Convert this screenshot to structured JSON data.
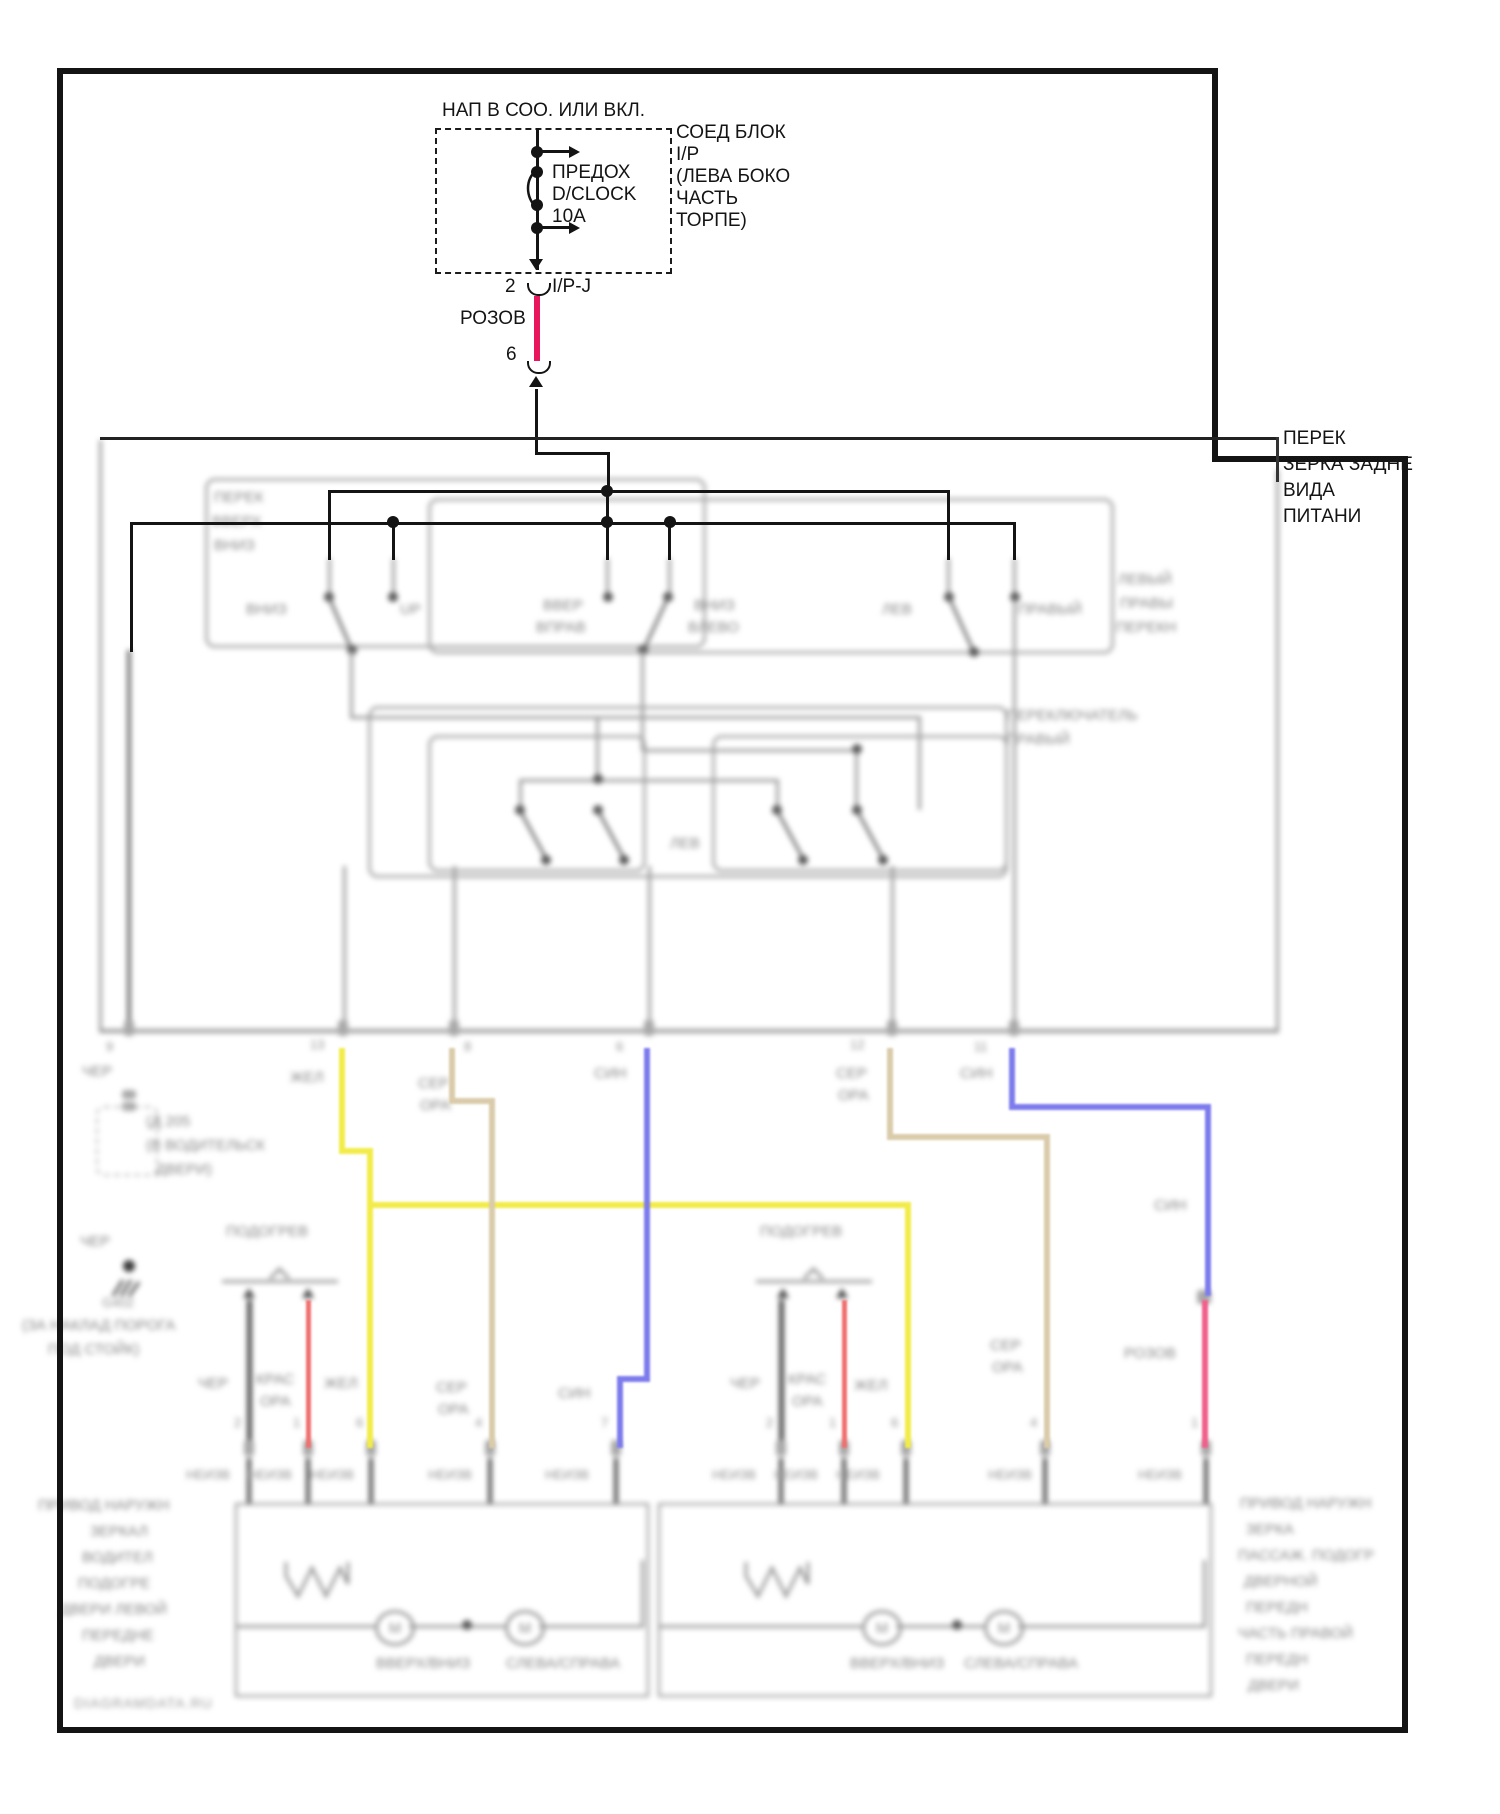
{
  "colors": {
    "wire_pink": "#e8175d",
    "wire_pink_light": "#f0608c",
    "wire_yellow": "#f2ec4a",
    "wire_tan": "#dacbaa",
    "wire_blue": "#7d7cec",
    "wire_red_orange": "#ef6f6f",
    "line_black": "#141414",
    "line_gray": "#9c9c9c",
    "text_blur": "#878787"
  },
  "fuse_block": {
    "note": "НАП В СОО. ИЛИ ВКЛ.",
    "fuse": [
      "ПРЕДОХ",
      "D/CLOCK",
      "10A"
    ],
    "block": [
      "СОЕД БЛОК",
      "I/P",
      "(ЛЕВА БОКО",
      "ЧАСТЬ",
      "ТОРПЕ)"
    ],
    "pin": "2",
    "connector": "I/P-J",
    "wire_color": "РОЗОВ",
    "splice": "6"
  },
  "switch_label": [
    "ПЕРЕК",
    "ЗЕРКА ЗАДНЕ",
    "ВИДА",
    "ПИТАНИ"
  ],
  "motor_letter": "М",
  "labels": [
    {
      "n": "mirror-switch-sub-label",
      "t": "ПЕРЕК",
      "x": 214,
      "y": 490,
      "c": "b"
    },
    {
      "n": "mirror-switch-sub-label",
      "t": "ВВЕРХ",
      "x": 212,
      "y": 514,
      "c": "b"
    },
    {
      "n": "mirror-switch-sub-label",
      "t": "ВНИЗ",
      "x": 214,
      "y": 538,
      "c": "b"
    },
    {
      "n": "contact-label-down",
      "t": "ВНИЗ",
      "x": 246,
      "y": 602,
      "c": "b"
    },
    {
      "n": "contact-label-up",
      "t": "UP",
      "x": 400,
      "y": 602,
      "c": "b"
    },
    {
      "n": "contact-label-upright",
      "t": "ВВЕР",
      "x": 543,
      "y": 598,
      "c": "b"
    },
    {
      "n": "contact-label-upright",
      "t": "ВПРАВ",
      "x": 536,
      "y": 620,
      "c": "b"
    },
    {
      "n": "contact-label-downleft",
      "t": "ВНИЗ",
      "x": 694,
      "y": 598,
      "c": "b"
    },
    {
      "n": "contact-label-downleft",
      "t": "ВЛЕВО",
      "x": 688,
      "y": 620,
      "c": "b"
    },
    {
      "n": "contact-label-left",
      "t": "ЛЕВ",
      "x": 882,
      "y": 602,
      "c": "b"
    },
    {
      "n": "contact-label-right",
      "t": "ПРАВЫЙ",
      "x": 1018,
      "y": 602,
      "c": "b"
    },
    {
      "n": "selector-label",
      "t": "ЛЕВЫЙ",
      "x": 1118,
      "y": 572,
      "c": "b"
    },
    {
      "n": "selector-label",
      "t": "ПРАВЫ",
      "x": 1120,
      "y": 596,
      "c": "b"
    },
    {
      "n": "selector-label",
      "t": "ПЕРЕКН",
      "x": 1116,
      "y": 620,
      "c": "b"
    },
    {
      "n": "switch2-label-lev",
      "t": "ЛЕВ",
      "x": 670,
      "y": 836,
      "c": "b"
    },
    {
      "n": "switch2-right-label",
      "t": "ПЕРЕКЛЮЧАТЕЛЬ",
      "x": 1006,
      "y": 708,
      "c": "b"
    },
    {
      "n": "switch2-right-label",
      "t": "ПРАВЫЙ",
      "x": 1006,
      "y": 732,
      "c": "b"
    },
    {
      "n": "pin-number",
      "t": "9",
      "x": 106,
      "y": 1040,
      "c": "s"
    },
    {
      "n": "pin-number",
      "t": "13",
      "x": 310,
      "y": 1038,
      "c": "s"
    },
    {
      "n": "pin-number",
      "t": "8",
      "x": 464,
      "y": 1040,
      "c": "s"
    },
    {
      "n": "pin-number",
      "t": "6",
      "x": 616,
      "y": 1040,
      "c": "s"
    },
    {
      "n": "pin-number",
      "t": "12",
      "x": 850,
      "y": 1038,
      "c": "s"
    },
    {
      "n": "pin-number",
      "t": "11",
      "x": 974,
      "y": 1040,
      "c": "s"
    },
    {
      "n": "wire-color-label",
      "t": "ЧЕР",
      "x": 82,
      "y": 1064,
      "c": "b"
    },
    {
      "n": "wire-color-label",
      "t": "ЖЕЛ",
      "x": 290,
      "y": 1070,
      "c": "b"
    },
    {
      "n": "wire-color-label",
      "t": "СЕР",
      "x": 418,
      "y": 1076,
      "c": "b"
    },
    {
      "n": "wire-color-label",
      "t": "ОРА",
      "x": 420,
      "y": 1098,
      "c": "b"
    },
    {
      "n": "wire-color-label",
      "t": "СИН",
      "x": 594,
      "y": 1066,
      "c": "b"
    },
    {
      "n": "wire-color-label",
      "t": "СЕР",
      "x": 836,
      "y": 1066,
      "c": "b"
    },
    {
      "n": "wire-color-label",
      "t": "ОРА",
      "x": 838,
      "y": 1088,
      "c": "b"
    },
    {
      "n": "wire-color-label",
      "t": "СИН",
      "x": 960,
      "y": 1066,
      "c": "b"
    },
    {
      "n": "door-connector-label",
      "t": "(Д 205",
      "x": 146,
      "y": 1114,
      "c": "b"
    },
    {
      "n": "door-connector-label",
      "t": "(В ВОДИТЕЛЬСК",
      "x": 146,
      "y": 1138,
      "c": "b"
    },
    {
      "n": "door-connector-label",
      "t": "ДВЕРИ)",
      "x": 156,
      "y": 1162,
      "c": "b"
    },
    {
      "n": "wire-color-label",
      "t": "ЧЕР",
      "x": 80,
      "y": 1234,
      "c": "b"
    },
    {
      "n": "ground-id-label",
      "t": "G402",
      "x": 102,
      "y": 1296,
      "c": "s"
    },
    {
      "n": "ground-location-label",
      "t": "(ЗА НАКЛАД ПОРОГА",
      "x": 22,
      "y": 1318,
      "c": "b"
    },
    {
      "n": "ground-location-label",
      "t": "ПОД СТОЙК)",
      "x": 48,
      "y": 1342,
      "c": "b"
    },
    {
      "n": "heater-label",
      "t": "ПОДОГРЕВ",
      "x": 226,
      "y": 1224,
      "c": "b"
    },
    {
      "n": "heater-label",
      "t": "ПОДОГРЕВ",
      "x": 760,
      "y": 1224,
      "c": "b"
    },
    {
      "n": "wire-color-label",
      "t": "СИН",
      "x": 1154,
      "y": 1198,
      "c": "b"
    },
    {
      "n": "wire-color-label",
      "t": "СЕР",
      "x": 990,
      "y": 1338,
      "c": "b"
    },
    {
      "n": "wire-color-label",
      "t": "ОРА",
      "x": 992,
      "y": 1360,
      "c": "b"
    },
    {
      "n": "wire-color-label",
      "t": "РОЗОВ",
      "x": 1124,
      "y": 1346,
      "c": "b"
    },
    {
      "n": "wire-color-label",
      "t": "ЧЕР",
      "x": 198,
      "y": 1376,
      "c": "b"
    },
    {
      "n": "wire-color-label",
      "t": "КРАС",
      "x": 256,
      "y": 1372,
      "c": "b"
    },
    {
      "n": "wire-color-label",
      "t": "ОРА",
      "x": 260,
      "y": 1394,
      "c": "b"
    },
    {
      "n": "wire-color-label",
      "t": "ЖЕЛ",
      "x": 324,
      "y": 1376,
      "c": "b"
    },
    {
      "n": "wire-color-label",
      "t": "СЕР",
      "x": 436,
      "y": 1380,
      "c": "b"
    },
    {
      "n": "wire-color-label",
      "t": "ОРА",
      "x": 438,
      "y": 1402,
      "c": "b"
    },
    {
      "n": "wire-color-label",
      "t": "СИН",
      "x": 558,
      "y": 1386,
      "c": "b"
    },
    {
      "n": "wire-color-label",
      "t": "ЧЕР",
      "x": 730,
      "y": 1376,
      "c": "b"
    },
    {
      "n": "wire-color-label",
      "t": "КРАС",
      "x": 788,
      "y": 1372,
      "c": "b"
    },
    {
      "n": "wire-color-label",
      "t": "ОРА",
      "x": 792,
      "y": 1394,
      "c": "b"
    },
    {
      "n": "wire-color-label",
      "t": "ЖЕЛ",
      "x": 854,
      "y": 1378,
      "c": "b"
    },
    {
      "n": "pin-number",
      "t": "2",
      "x": 234,
      "y": 1416,
      "c": "s"
    },
    {
      "n": "pin-number",
      "t": "1",
      "x": 293,
      "y": 1416,
      "c": "s"
    },
    {
      "n": "pin-number",
      "t": "6",
      "x": 356,
      "y": 1416,
      "c": "s"
    },
    {
      "n": "pin-number",
      "t": "4",
      "x": 475,
      "y": 1416,
      "c": "s"
    },
    {
      "n": "pin-number",
      "t": "7",
      "x": 601,
      "y": 1416,
      "c": "s"
    },
    {
      "n": "pin-number",
      "t": "2",
      "x": 766,
      "y": 1416,
      "c": "s"
    },
    {
      "n": "pin-number",
      "t": "1",
      "x": 829,
      "y": 1416,
      "c": "s"
    },
    {
      "n": "pin-number",
      "t": "6",
      "x": 891,
      "y": 1416,
      "c": "s"
    },
    {
      "n": "pin-number",
      "t": "4",
      "x": 1030,
      "y": 1416,
      "c": "s"
    },
    {
      "n": "pin-number",
      "t": "1",
      "x": 1191,
      "y": 1416,
      "c": "s"
    },
    {
      "n": "connector-name",
      "t": "НЕИЗВ",
      "x": 186,
      "y": 1468,
      "c": "s"
    },
    {
      "n": "connector-name",
      "t": "НЕИЗВ",
      "x": 248,
      "y": 1468,
      "c": "s"
    },
    {
      "n": "connector-name",
      "t": "НЕИЗВ",
      "x": 310,
      "y": 1468,
      "c": "s"
    },
    {
      "n": "connector-name",
      "t": "НЕИЗВ",
      "x": 428,
      "y": 1468,
      "c": "s"
    },
    {
      "n": "connector-name",
      "t": "НЕИЗВ",
      "x": 545,
      "y": 1468,
      "c": "s"
    },
    {
      "n": "connector-name",
      "t": "НЕИЗВ",
      "x": 712,
      "y": 1468,
      "c": "s"
    },
    {
      "n": "connector-name",
      "t": "НЕИЗВ",
      "x": 774,
      "y": 1468,
      "c": "s"
    },
    {
      "n": "connector-name",
      "t": "НЕИЗВ",
      "x": 836,
      "y": 1468,
      "c": "s"
    },
    {
      "n": "connector-name",
      "t": "НЕИЗВ",
      "x": 988,
      "y": 1468,
      "c": "s"
    },
    {
      "n": "connector-name",
      "t": "НЕИЗВ",
      "x": 1138,
      "y": 1468,
      "c": "s"
    },
    {
      "n": "motor-function-label",
      "t": "ВВЕРХ/ВНИЗ",
      "x": 376,
      "y": 1656,
      "c": "b"
    },
    {
      "n": "motor-function-label",
      "t": "СЛЕВА/СПРАВА",
      "x": 506,
      "y": 1656,
      "c": "b"
    },
    {
      "n": "motor-function-label",
      "t": "ВВЕРХ/ВНИЗ",
      "x": 850,
      "y": 1656,
      "c": "b"
    },
    {
      "n": "motor-function-label",
      "t": "СЛЕВА/СПРАВА",
      "x": 964,
      "y": 1656,
      "c": "b"
    },
    {
      "n": "left-mirror-label",
      "t": "ПРИВОД НАРУЖН",
      "x": 38,
      "y": 1498,
      "c": "b"
    },
    {
      "n": "left-mirror-label",
      "t": "ЗЕРКАЛ",
      "x": 90,
      "y": 1524,
      "c": "b"
    },
    {
      "n": "left-mirror-label",
      "t": "ВОДИТЕЛ",
      "x": 82,
      "y": 1550,
      "c": "b"
    },
    {
      "n": "left-mirror-label",
      "t": "ПОДОГРЕ",
      "x": 78,
      "y": 1576,
      "c": "b"
    },
    {
      "n": "left-mirror-label",
      "t": "ДВЕРИ ЛЕВОЙ",
      "x": 60,
      "y": 1602,
      "c": "b"
    },
    {
      "n": "left-mirror-label",
      "t": "ПЕРЕДНЕ",
      "x": 82,
      "y": 1628,
      "c": "b"
    },
    {
      "n": "left-mirror-label",
      "t": "ДВЕРИ",
      "x": 94,
      "y": 1654,
      "c": "b"
    },
    {
      "n": "right-mirror-label",
      "t": "ПРИВОД НАРУЖН",
      "x": 1240,
      "y": 1496,
      "c": "b"
    },
    {
      "n": "right-mirror-label",
      "t": "ЗЕРКА",
      "x": 1246,
      "y": 1522,
      "c": "b"
    },
    {
      "n": "right-mirror-label",
      "t": "ПАССАЖ. ПОДОГР",
      "x": 1238,
      "y": 1548,
      "c": "b"
    },
    {
      "n": "right-mirror-label",
      "t": "ДВЕРНОЙ",
      "x": 1244,
      "y": 1574,
      "c": "b"
    },
    {
      "n": "right-mirror-label",
      "t": "ПЕРЕДН",
      "x": 1246,
      "y": 1600,
      "c": "b"
    },
    {
      "n": "right-mirror-label",
      "t": "ЧАСТЬ ПРАВОЙ",
      "x": 1238,
      "y": 1626,
      "c": "b"
    },
    {
      "n": "right-mirror-label",
      "t": "ПЕРЕДН",
      "x": 1246,
      "y": 1652,
      "c": "b"
    },
    {
      "n": "right-mirror-label",
      "t": "ДВЕРИ",
      "x": 1248,
      "y": 1678,
      "c": "b"
    },
    {
      "n": "watermark",
      "t": "DIAGRAMDATA.RU",
      "x": 74,
      "y": 1696,
      "c": "w"
    }
  ]
}
